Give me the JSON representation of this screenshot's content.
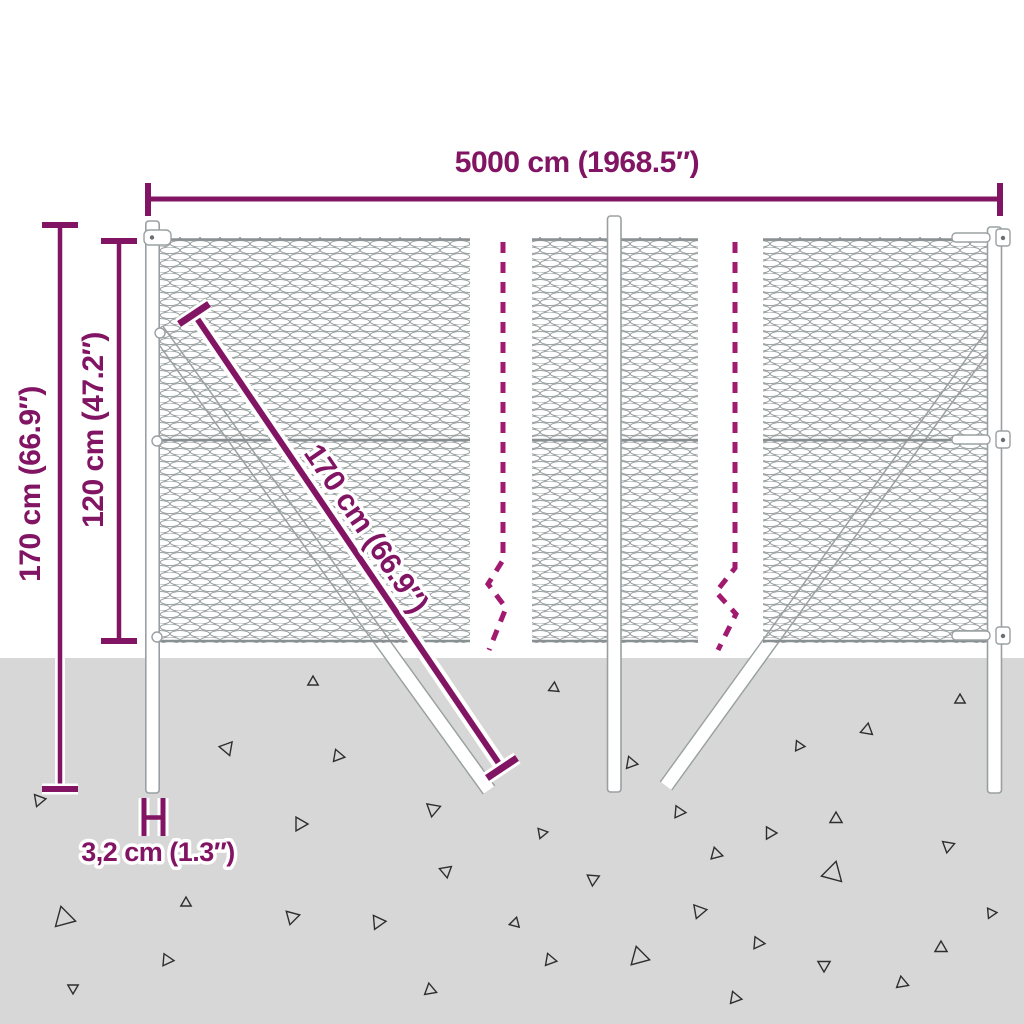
{
  "colors": {
    "accent": "#821464",
    "dash": "#a11a70",
    "ground": "#d7d7d7",
    "mesh": "#9aa0a1",
    "rail": "#8a8f91",
    "outline": "#9aa0a2",
    "triangle": "#2e2e2e"
  },
  "product": {
    "type": "chain-link fence with posts and strut anchors"
  },
  "dimensions": {
    "width": {
      "value": "5000 cm (1968.5″)"
    },
    "total_height": {
      "value": "170 cm (66.9″)"
    },
    "mesh_height": {
      "value": "120 cm (47.2″)"
    },
    "strut_length": {
      "value": "170 cm (66.9″)"
    },
    "post_diameter": {
      "value": "3,2 cm (1.3″)"
    }
  },
  "ground": {
    "triangles": [
      {
        "x": 313,
        "y": 682,
        "r": 6,
        "a": 0
      },
      {
        "x": 227,
        "y": 748,
        "r": 8,
        "a": 40
      },
      {
        "x": 338,
        "y": 756,
        "r": 7,
        "a": 100
      },
      {
        "x": 39,
        "y": 800,
        "r": 7,
        "a": 80
      },
      {
        "x": 300,
        "y": 824,
        "r": 8,
        "a": 90
      },
      {
        "x": 433,
        "y": 809,
        "r": 8,
        "a": 70
      },
      {
        "x": 446,
        "y": 871,
        "r": 7,
        "a": 50
      },
      {
        "x": 64,
        "y": 918,
        "r": 12,
        "a": -15
      },
      {
        "x": 186,
        "y": 903,
        "r": 6,
        "a": 120
      },
      {
        "x": 292,
        "y": 917,
        "r": 8,
        "a": 75
      },
      {
        "x": 378,
        "y": 922,
        "r": 8,
        "a": 85
      },
      {
        "x": 167,
        "y": 960,
        "r": 7,
        "a": 95
      },
      {
        "x": 73,
        "y": 988,
        "r": 6,
        "a": 60
      },
      {
        "x": 430,
        "y": 990,
        "r": 7,
        "a": 110
      },
      {
        "x": 554,
        "y": 688,
        "r": 6,
        "a": 5
      },
      {
        "x": 960,
        "y": 700,
        "r": 6,
        "a": 0
      },
      {
        "x": 867,
        "y": 730,
        "r": 7,
        "a": 10
      },
      {
        "x": 799,
        "y": 746,
        "r": 6,
        "a": 95
      },
      {
        "x": 631,
        "y": 763,
        "r": 7,
        "a": 100
      },
      {
        "x": 679,
        "y": 812,
        "r": 7,
        "a": 95
      },
      {
        "x": 542,
        "y": 833,
        "r": 6,
        "a": 80
      },
      {
        "x": 836,
        "y": 819,
        "r": 7,
        "a": 0
      },
      {
        "x": 770,
        "y": 833,
        "r": 7,
        "a": 90
      },
      {
        "x": 716,
        "y": 854,
        "r": 7,
        "a": 105
      },
      {
        "x": 948,
        "y": 846,
        "r": 7,
        "a": 70
      },
      {
        "x": 833,
        "y": 873,
        "r": 12,
        "a": 15
      },
      {
        "x": 593,
        "y": 879,
        "r": 7,
        "a": 65
      },
      {
        "x": 699,
        "y": 911,
        "r": 8,
        "a": 80
      },
      {
        "x": 515,
        "y": 923,
        "r": 6,
        "a": 15
      },
      {
        "x": 758,
        "y": 943,
        "r": 7,
        "a": 95
      },
      {
        "x": 941,
        "y": 948,
        "r": 7,
        "a": 120
      },
      {
        "x": 991,
        "y": 913,
        "r": 6,
        "a": 85
      },
      {
        "x": 550,
        "y": 960,
        "r": 7,
        "a": 100
      },
      {
        "x": 639,
        "y": 957,
        "r": 11,
        "a": 105
      },
      {
        "x": 824,
        "y": 965,
        "r": 7,
        "a": 60
      },
      {
        "x": 902,
        "y": 983,
        "r": 7,
        "a": 110
      },
      {
        "x": 735,
        "y": 998,
        "r": 7,
        "a": 100
      }
    ]
  }
}
